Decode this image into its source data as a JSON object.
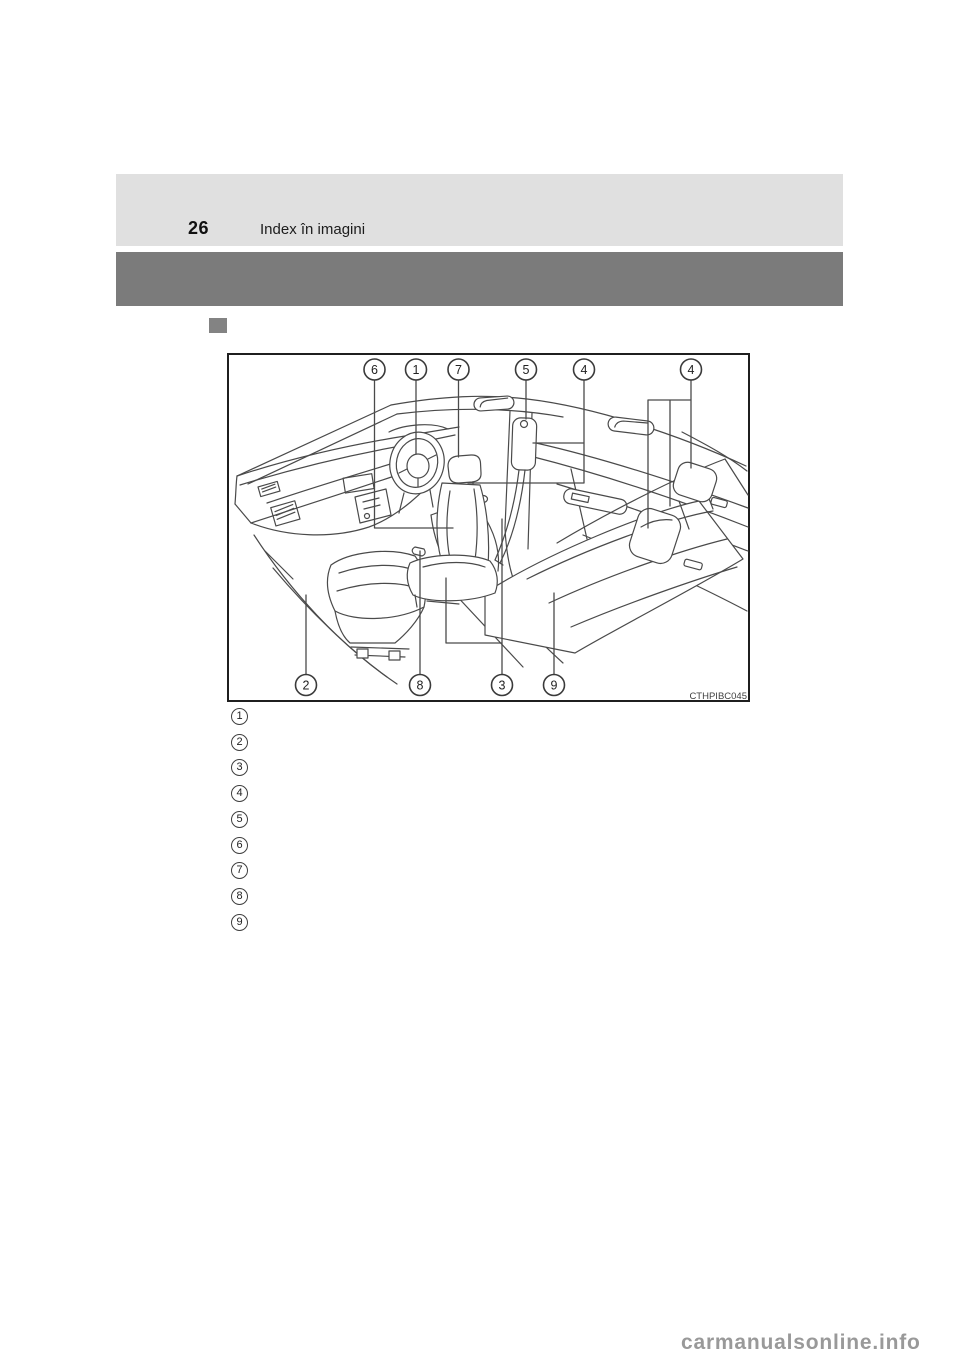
{
  "page": {
    "number": "26",
    "header_title": "Index în imagini"
  },
  "figure": {
    "code": "CTHPIBC045",
    "callouts": [
      {
        "label": "6",
        "x": 147.5,
        "y": 16.5
      },
      {
        "label": "1",
        "x": 189,
        "y": 16.5
      },
      {
        "label": "7",
        "x": 231.5,
        "y": 16.5
      },
      {
        "label": "5",
        "x": 299,
        "y": 16.5
      },
      {
        "label": "4",
        "x": 357,
        "y": 16.5
      },
      {
        "label": "4",
        "x": 464,
        "y": 16.5
      },
      {
        "label": "2",
        "x": 79,
        "y": 332
      },
      {
        "label": "8",
        "x": 193,
        "y": 332
      },
      {
        "label": "3",
        "x": 275,
        "y": 332
      },
      {
        "label": "9",
        "x": 327,
        "y": 332
      }
    ]
  },
  "legend": {
    "items": [
      "1",
      "2",
      "3",
      "4",
      "5",
      "6",
      "7",
      "8",
      "9"
    ]
  },
  "watermark": {
    "text": "carmanualsonline.info"
  },
  "colors": {
    "band_light": "#e0e0e0",
    "band_dark": "#7b7b7b",
    "bullet": "#838383",
    "line": "#4a4a4a",
    "watermark": "#999999"
  }
}
